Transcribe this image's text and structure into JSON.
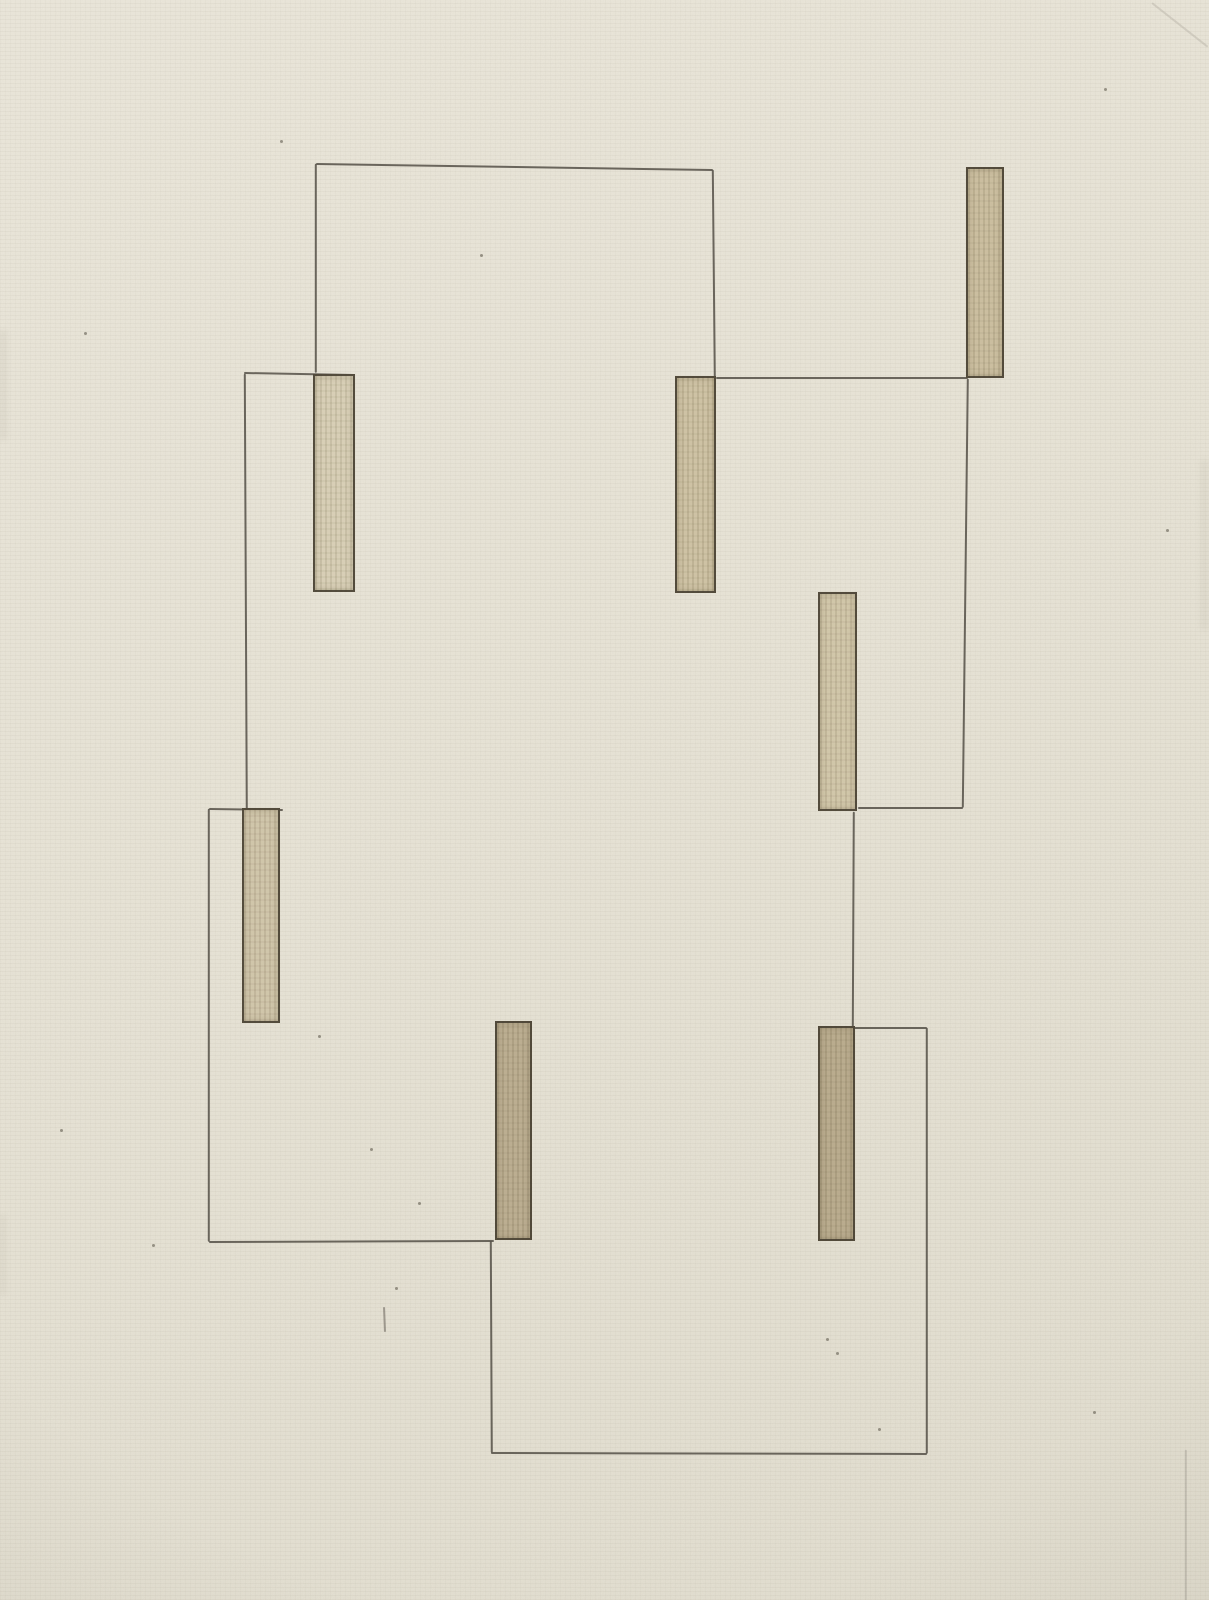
{
  "artwork": {
    "canvas": {
      "width": 1209,
      "height": 1600
    },
    "colors": {
      "paper": "#e8e4d7",
      "pencil": "#57524a",
      "bar_outline": "#4a4034",
      "bar_fill_light": "#d8cfb5",
      "bar_fill_dark": "#b7a98a"
    },
    "lines": [
      {
        "x1": 244,
        "y1": 372,
        "x2": 355,
        "y2": 374
      },
      {
        "x1": 316,
        "y1": 163,
        "x2": 316,
        "y2": 372
      },
      {
        "x1": 316,
        "y1": 163,
        "x2": 713,
        "y2": 169
      },
      {
        "x1": 713,
        "y1": 169,
        "x2": 715,
        "y2": 376
      },
      {
        "x1": 716,
        "y1": 377,
        "x2": 968,
        "y2": 377
      },
      {
        "x1": 968,
        "y1": 378,
        "x2": 963,
        "y2": 807
      },
      {
        "x1": 858,
        "y1": 807,
        "x2": 963,
        "y2": 807
      },
      {
        "x1": 854,
        "y1": 811,
        "x2": 853,
        "y2": 1026
      },
      {
        "x1": 245,
        "y1": 373,
        "x2": 247,
        "y2": 810
      },
      {
        "x1": 209,
        "y1": 808,
        "x2": 283,
        "y2": 809
      },
      {
        "x1": 209,
        "y1": 808,
        "x2": 209,
        "y2": 1241
      },
      {
        "x1": 209,
        "y1": 1241,
        "x2": 494,
        "y2": 1240
      },
      {
        "x1": 491,
        "y1": 1240,
        "x2": 492,
        "y2": 1452
      },
      {
        "x1": 491,
        "y1": 1452,
        "x2": 927,
        "y2": 1453
      },
      {
        "x1": 927,
        "y1": 1027,
        "x2": 927,
        "y2": 1453
      },
      {
        "x1": 818,
        "y1": 1027,
        "x2": 927,
        "y2": 1027
      },
      {
        "x1": 384,
        "y1": 1306,
        "x2": 385,
        "y2": 1331,
        "w": 2,
        "o": 0.5
      },
      {
        "x1": 1152,
        "y1": 2,
        "x2": 1208,
        "y2": 46,
        "o": 0.15
      },
      {
        "x1": 1186,
        "y1": 1449,
        "x2": 1186,
        "y2": 1600,
        "o": 0.2
      }
    ],
    "bars": [
      {
        "x": 313,
        "y": 374,
        "w": 42,
        "h": 218,
        "fill": "#d8cfb5"
      },
      {
        "x": 675,
        "y": 376,
        "w": 41,
        "h": 217,
        "fill": "#cdc1a2"
      },
      {
        "x": 242,
        "y": 808,
        "w": 38,
        "h": 215,
        "fill": "#d0c5a9"
      },
      {
        "x": 966,
        "y": 167,
        "w": 38,
        "h": 211,
        "fill": "#cabd9d"
      },
      {
        "x": 818,
        "y": 592,
        "w": 39,
        "h": 219,
        "fill": "#d1c6a8"
      },
      {
        "x": 818,
        "y": 1026,
        "w": 37,
        "h": 215,
        "fill": "#b7a98a"
      },
      {
        "x": 495,
        "y": 1021,
        "w": 37,
        "h": 219,
        "fill": "#b9ab8d"
      }
    ],
    "specks": [
      [
        280,
        140
      ],
      [
        480,
        254
      ],
      [
        318,
        1035
      ],
      [
        370,
        1148
      ],
      [
        418,
        1202
      ],
      [
        826,
        1338
      ],
      [
        836,
        1352
      ],
      [
        878,
        1428
      ],
      [
        1093,
        1411
      ],
      [
        395,
        1287
      ],
      [
        84,
        332
      ],
      [
        1166,
        529
      ],
      [
        152,
        1244
      ],
      [
        1104,
        88
      ],
      [
        60,
        1129
      ]
    ],
    "smudges": [
      {
        "x": 0,
        "y": 330,
        "w": 7,
        "h": 110,
        "o": 0.07
      },
      {
        "x": 0,
        "y": 1215,
        "w": 6,
        "h": 80,
        "o": 0.06
      },
      {
        "x": 1200,
        "y": 460,
        "w": 9,
        "h": 170,
        "o": 0.05
      }
    ]
  }
}
